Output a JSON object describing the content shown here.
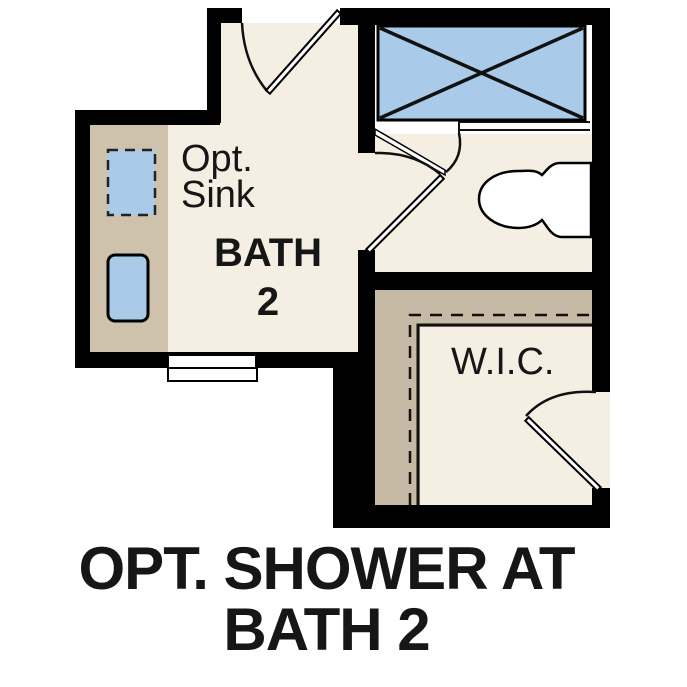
{
  "plan": {
    "caption": {
      "line1": "OPT. SHOWER AT",
      "line2": "BATH 2"
    },
    "rooms": {
      "bath": {
        "label_line1": "BATH",
        "label_line2": "2"
      },
      "wic": {
        "label": "W.I.C."
      }
    },
    "annotations": {
      "opt_sink_line1": "Opt.",
      "opt_sink_line2": "Sink"
    },
    "fixtures": [
      "shower-pan",
      "toilet",
      "optional-sink",
      "sink",
      "vanity-counter",
      "cased-opening",
      "closet-shelf-and-rod"
    ]
  },
  "colors": {
    "background": "#ffffff",
    "floor": "#f5eee2",
    "counter": "#cec2ac",
    "closet_band": "#c6baa4",
    "fixture_blue": "#a9cbe9",
    "wall": "#000000",
    "line": "#111111"
  }
}
